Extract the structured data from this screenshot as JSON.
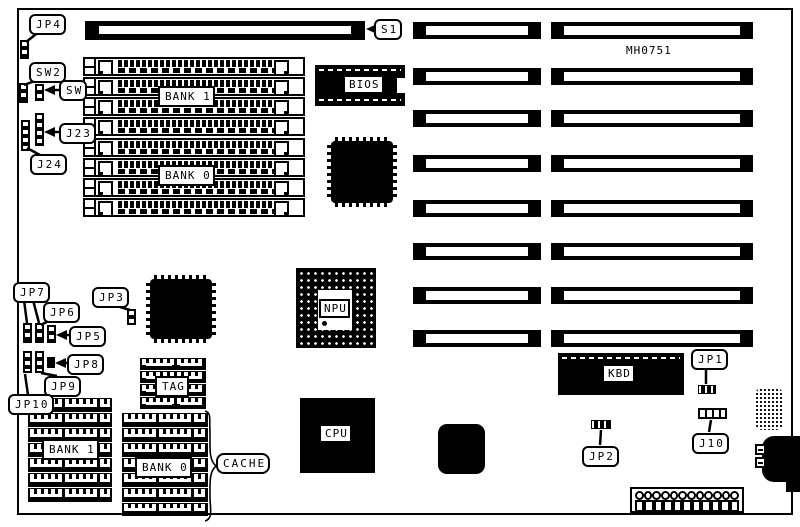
{
  "diagram": {
    "board_id": "MH0751",
    "type": "motherboard-layout-diagram",
    "colors": {
      "ink": "#000000",
      "background": "#ffffff"
    },
    "labels": {
      "jp4": "JP4",
      "sw2": "SW2",
      "sw": "SW",
      "j23": "J23",
      "j24": "J24",
      "s1": "S1",
      "bios": "BIOS",
      "bank1_top": "BANK 1",
      "bank0_top": "BANK 0",
      "jp3": "JP3",
      "jp7": "JP7",
      "jp6": "JP6",
      "jp5": "JP5",
      "jp8": "JP8",
      "jp9": "JP9",
      "jp10": "JP10",
      "npu": "NPU",
      "cpu": "CPU",
      "kbd": "KBD",
      "jp1": "JP1",
      "j10": "J10",
      "jp2": "JP2",
      "tag": "TAG",
      "bank1_bottom": "BANK 1",
      "bank0_bottom": "BANK 0",
      "cache": "CACHE"
    }
  }
}
